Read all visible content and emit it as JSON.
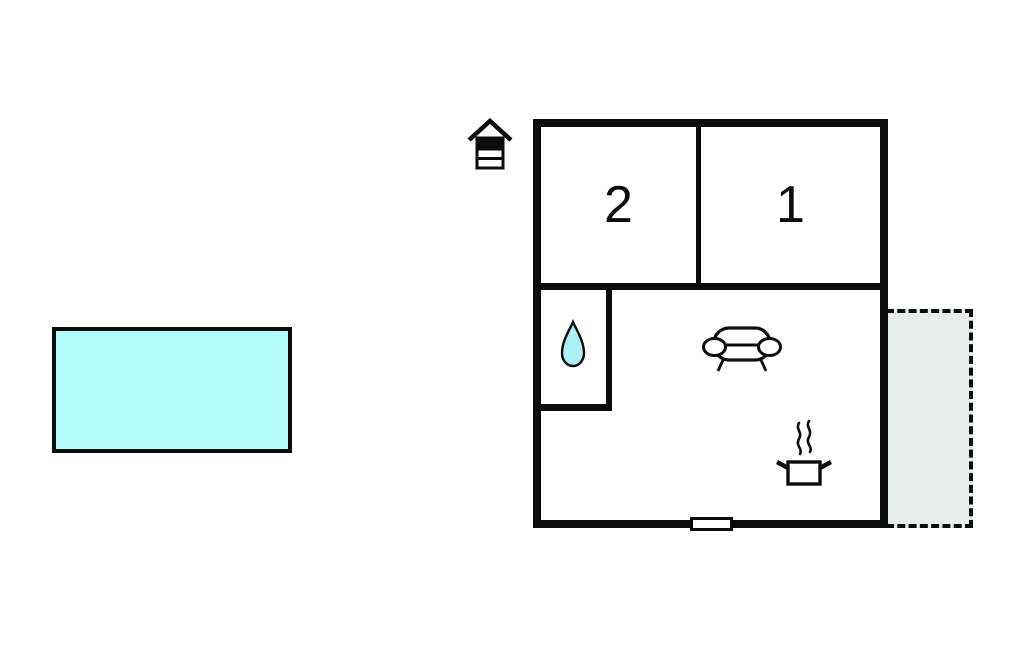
{
  "rooms": [
    {
      "label": "2"
    },
    {
      "label": "1"
    }
  ],
  "icons": [
    "grill-icon",
    "water-drop-icon",
    "sofa-icon",
    "cooking-pot-icon"
  ],
  "colors": {
    "wall_color": "#0c0c0c",
    "pool_fill": "#b3fafa",
    "drop_fill": "#aceff5",
    "terrace_fill": "#e8edeb",
    "canvas_bg": "#ffffff"
  }
}
